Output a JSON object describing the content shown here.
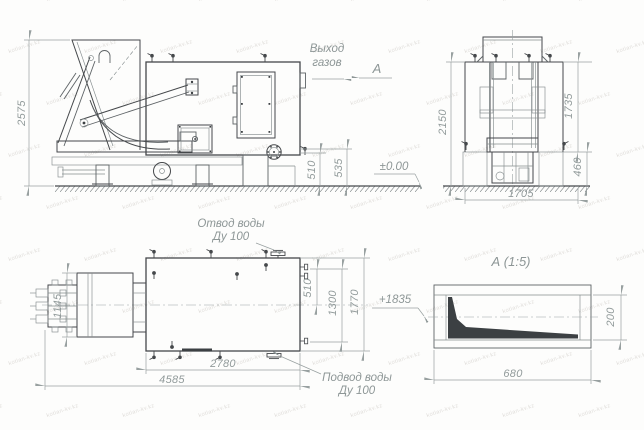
{
  "watermark": "kotlan-kv.kz",
  "labels": {
    "gas_outlet": {
      "line1": "Выход",
      "line2": "газов"
    },
    "section_arrow": "А",
    "elevation_ground": "±0.00",
    "elevation_inlet": "+1835",
    "water_outlet": {
      "line1": "Отвод воды",
      "line2": "Ду 100"
    },
    "water_inlet": {
      "line1": "Подвод воды",
      "line2": "Ду 100"
    },
    "detail_title": "А (1:5)"
  },
  "dimensions": {
    "side_view": {
      "overall_height": "2575",
      "drain_height": "510",
      "drain_height2": "535"
    },
    "front_view": {
      "overall_height": "2150",
      "body_height": "1735",
      "base_height": "460",
      "width": "1705"
    },
    "plan_view": {
      "stoker_width": "1145",
      "outlet_offset": "510",
      "width_inner": "1300",
      "width_overall": "1770",
      "body_length": "2780",
      "overall_length": "4585"
    },
    "detail_a": {
      "length": "680",
      "height": "200"
    }
  }
}
